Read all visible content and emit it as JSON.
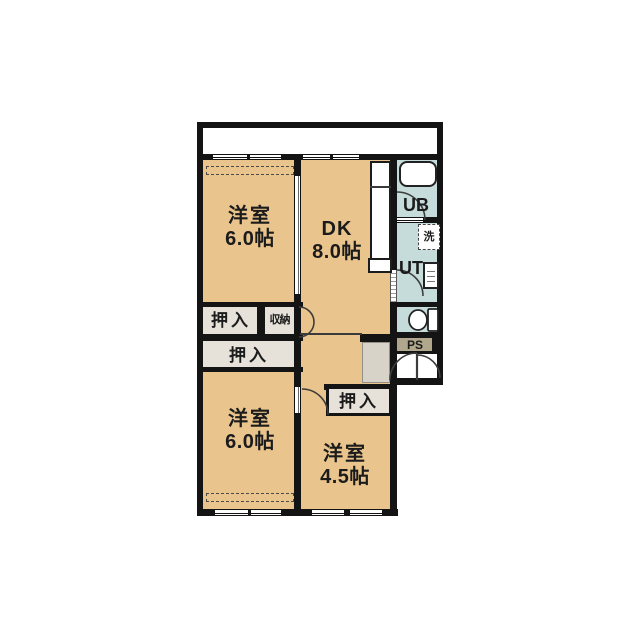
{
  "floorplan": {
    "rooms": [
      {
        "id": "bedroom-nw",
        "type": "洋室",
        "size": "6.0帖"
      },
      {
        "id": "dining-kitchen",
        "type": "DK",
        "size": "8.0帖"
      },
      {
        "id": "bedroom-sw",
        "type": "洋室",
        "size": "6.0帖"
      },
      {
        "id": "bedroom-se",
        "type": "洋室",
        "size": "4.5帖"
      }
    ],
    "closets": [
      {
        "id": "oshiire-north",
        "label": "押入"
      },
      {
        "id": "shuno-storage",
        "label": "収納"
      },
      {
        "id": "oshiire-mid",
        "label": "押入"
      },
      {
        "id": "oshiire-se",
        "label": "押入"
      }
    ],
    "utilities": [
      {
        "id": "unit-bath",
        "label": "UB"
      },
      {
        "id": "utility-room",
        "label": "UT"
      },
      {
        "id": "washing-machine",
        "label": "洗"
      },
      {
        "id": "pipe-space",
        "label": "PS"
      }
    ],
    "colors": {
      "room_floor": "#e9c48d",
      "wet_area": "#c5dcda",
      "closet": "#e6e2d9",
      "pipe_space": "#b1a78c",
      "wall": "#141414",
      "entry_step": "#d7d3c9"
    }
  }
}
